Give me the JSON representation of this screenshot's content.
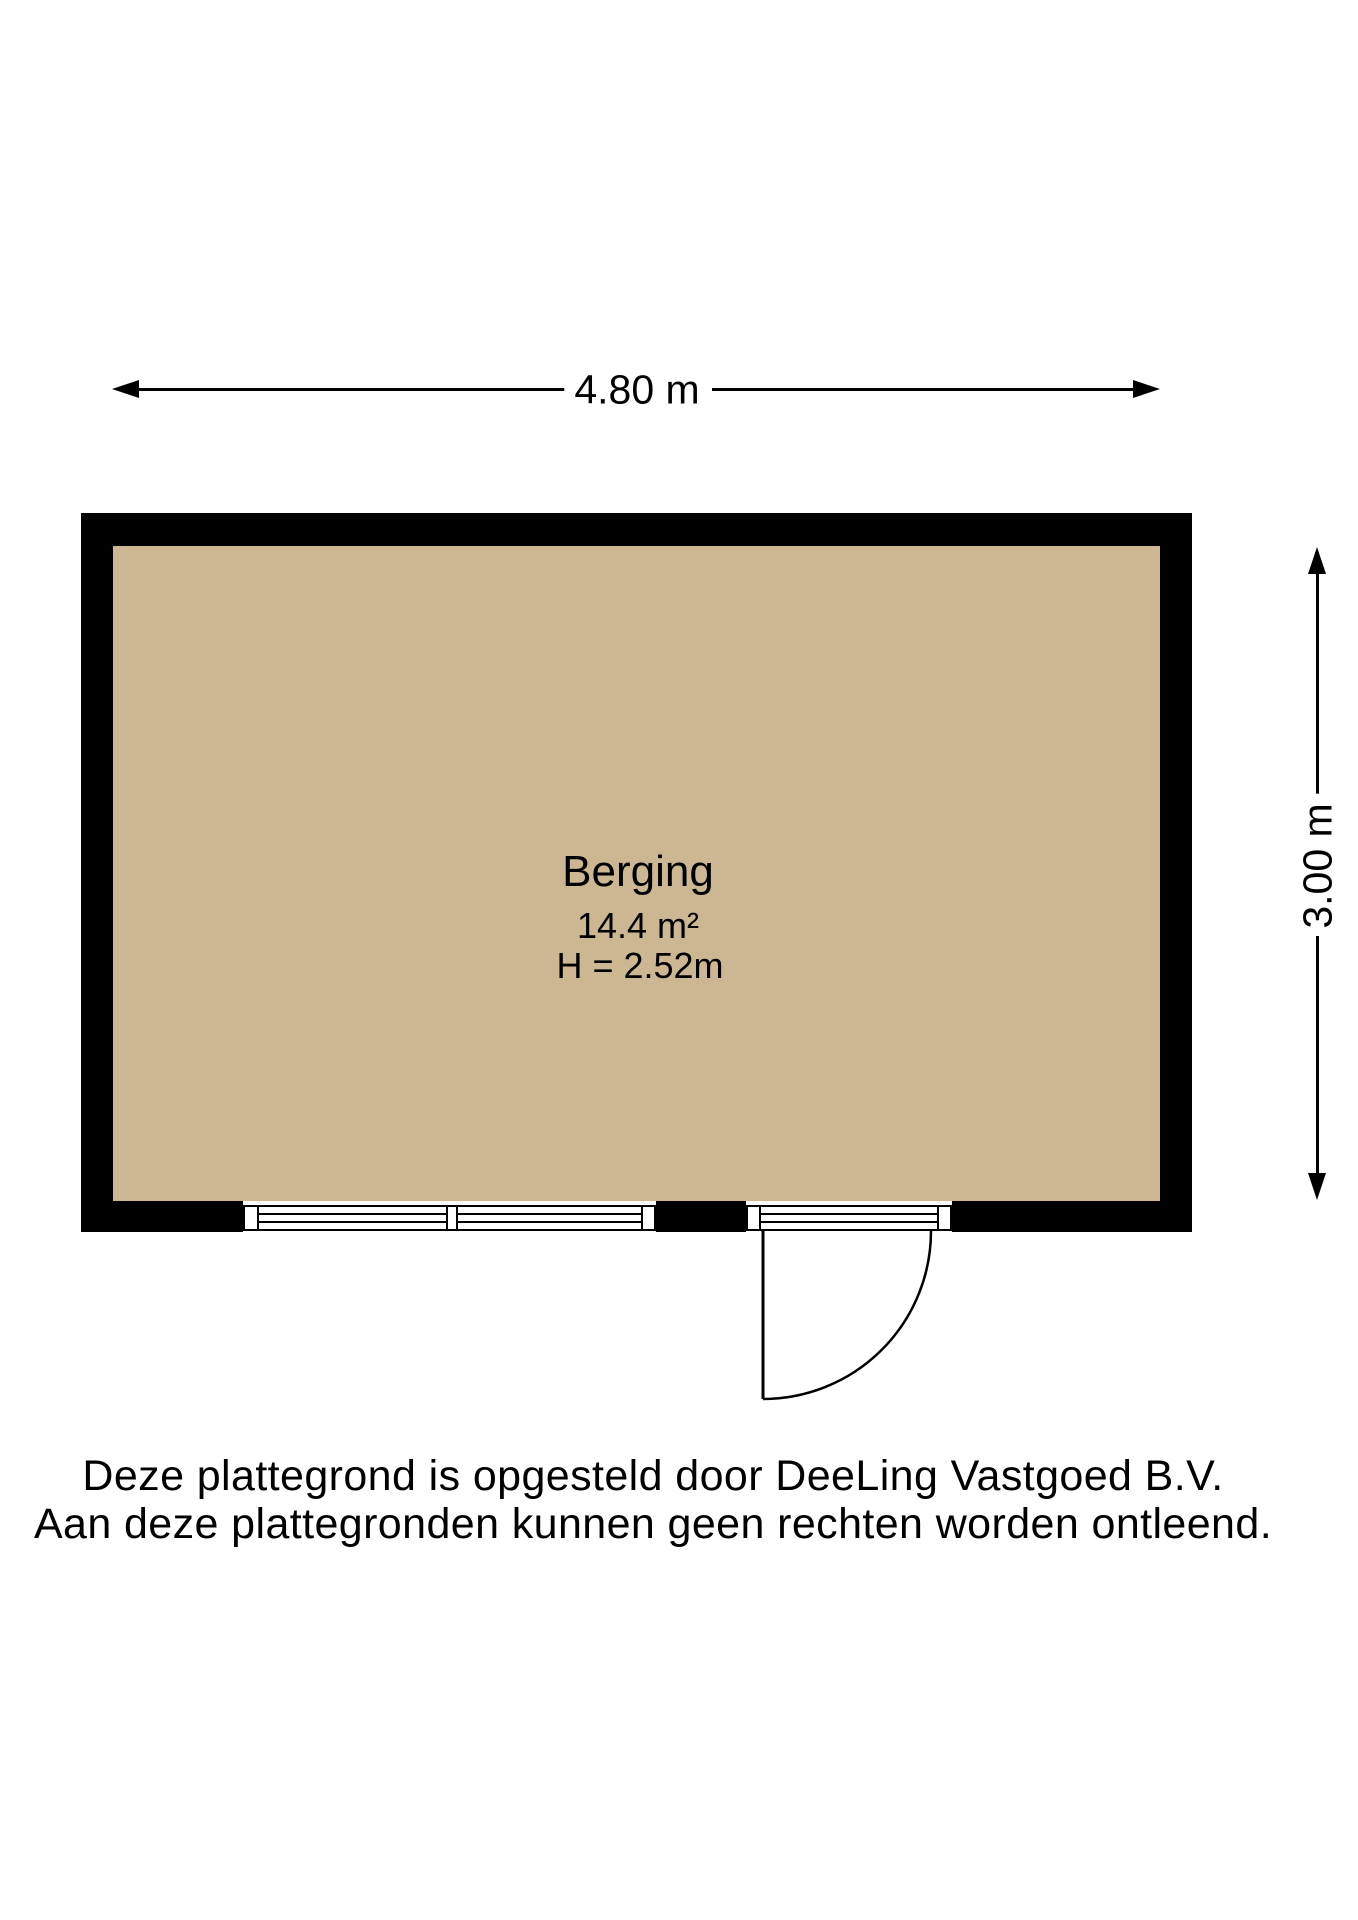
{
  "colors": {
    "background": "#ffffff",
    "floor": "#cdb692",
    "wall": "#000000",
    "ink": "#000000"
  },
  "dimensions": {
    "width_label": "4.80 m",
    "height_label": "3.00 m"
  },
  "room": {
    "name": "Berging",
    "area": "14.4 m²",
    "ceiling_height": "H = 2.52m"
  },
  "footer": {
    "line1": "Deze plattegrond is opgesteld door DeeLing Vastgoed B.V.",
    "line2": "Aan deze plattegronden kunnen geen rechten worden ontleend."
  }
}
